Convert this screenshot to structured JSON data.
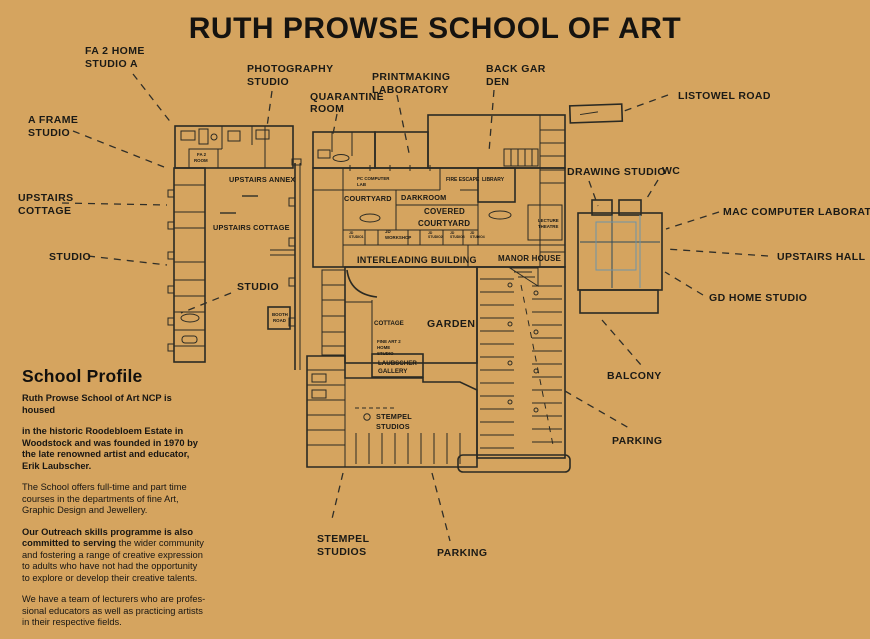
{
  "title": "RUTH PROWSE SCHOOL OF ART",
  "profile": {
    "heading": "School Profile",
    "para1": "Ruth Prowse School of Art NCP is housed",
    "para2": "in the historic Roodebloem Estate in\nWoodstock and was founded in 1970 by\nthe late renowned artist and educator,\nErik Laubscher.",
    "para3": "The School offers full-time and part time\ncourses in the departments of fine Art,\nGraphic Design and Jewellery.",
    "para4_bold": "Our Outreach skills programme is also committed to serving",
    "para4_rest": " the wider community and fostering a range of creative expression to adults who have not had the opportunity to explore or develop their creative talents.",
    "para5": "We have a team of lecturers who are profes-\nsional educators as well as practicing artists\nin their respective fields."
  },
  "callouts": {
    "fa2_home": {
      "line1": "FA 2 HOME",
      "line2": "STUDIO A"
    },
    "photography": {
      "line1": "PHOTOGRAPHY",
      "line2": "STUDIO"
    },
    "quarantine": {
      "line1": "QUARANTINE",
      "line2": "ROOM"
    },
    "printmaking": {
      "line1": "PRINTMAKING",
      "line2": "LABORATORY"
    },
    "back_garden": {
      "line1": "BACK GAR",
      "line2": "DEN"
    },
    "listowel": {
      "line1": "LISTOWEL ROAD"
    },
    "a_frame": {
      "line1": "A FRAME",
      "line2": "STUDIO"
    },
    "upstairs_cottage": {
      "line1": "UPSTAIRS",
      "line2": "COTTAGE"
    },
    "studio_west": {
      "line1": "STUDIO"
    },
    "studio_mid": {
      "line1": "STUDIO"
    },
    "drawing_studio": {
      "line1": "DRAWING STUDIO"
    },
    "wc": {
      "line1": "WC"
    },
    "mac_lab": {
      "line1": "MAC COMPUTER LABORATORY"
    },
    "upstairs_hall": {
      "line1": "UPSTAIRS HALL"
    },
    "gd_home": {
      "line1": "GD HOME STUDIO"
    },
    "balcony": {
      "line1": "BALCONY"
    },
    "parking_east": {
      "line1": "PARKING"
    },
    "stempel": {
      "line1": "STEMPEL",
      "line2": "STUDIOS"
    },
    "parking_south": {
      "line1": "PARKING"
    }
  },
  "map_labels": {
    "fa2_room_1": "FA 2",
    "fa2_room_2": "ROOM",
    "upstairs_annex": "UPSTAIRS ANNEX",
    "upstairs_cottage": "UPSTAIRS COTTAGE",
    "booth_1": "BOOTH",
    "booth_2": "ROAD",
    "pc_lab_1": "PC COMPUTER",
    "pc_lab_2": "LAB",
    "courtyard": "COURTYARD",
    "darkroom": "DARKROOM",
    "fire_escape": "FIRE ESCAPE",
    "library": "LIBRARY",
    "covered_1": "COVERED",
    "covered_2": "COURTYARD",
    "lecture_1": "LECTURE",
    "lecture_2": "THEATRE",
    "jd1_1": "JD",
    "jd1_2": "STUDIO1",
    "jdw_1": "JD",
    "jdw_2": "WORKSHOP",
    "jd2_1": "JD",
    "jd2_2": "STUDIO2",
    "jd3_1": "JD",
    "jd3_2": "STUDIO3",
    "jd4_1": "JD",
    "jd4_2": "STUDIO4",
    "interleading": "INTERLEADING BUILDING",
    "manor": "MANOR HOUSE",
    "cottage": "COTTAGE",
    "garden": "GARDEN",
    "fine_art_1": "FINE ART 2",
    "fine_art_2": "HOME",
    "fine_art_3": "STUDIO",
    "laubscher_1": "LAUBSCHER",
    "laubscher_2": "GALLERY",
    "stempel_1": "STEMPEL",
    "stempel_2": "STUDIOS"
  },
  "colors": {
    "background": "#d5a45f",
    "building_cream": "#f4e9cf",
    "building_light_blue": "#b6ccd8",
    "building_mid_blue": "#9cb6c6",
    "building_teal": "#4e7a93",
    "building_dark_teal": "#47708a",
    "ink": "#2b2a23"
  }
}
